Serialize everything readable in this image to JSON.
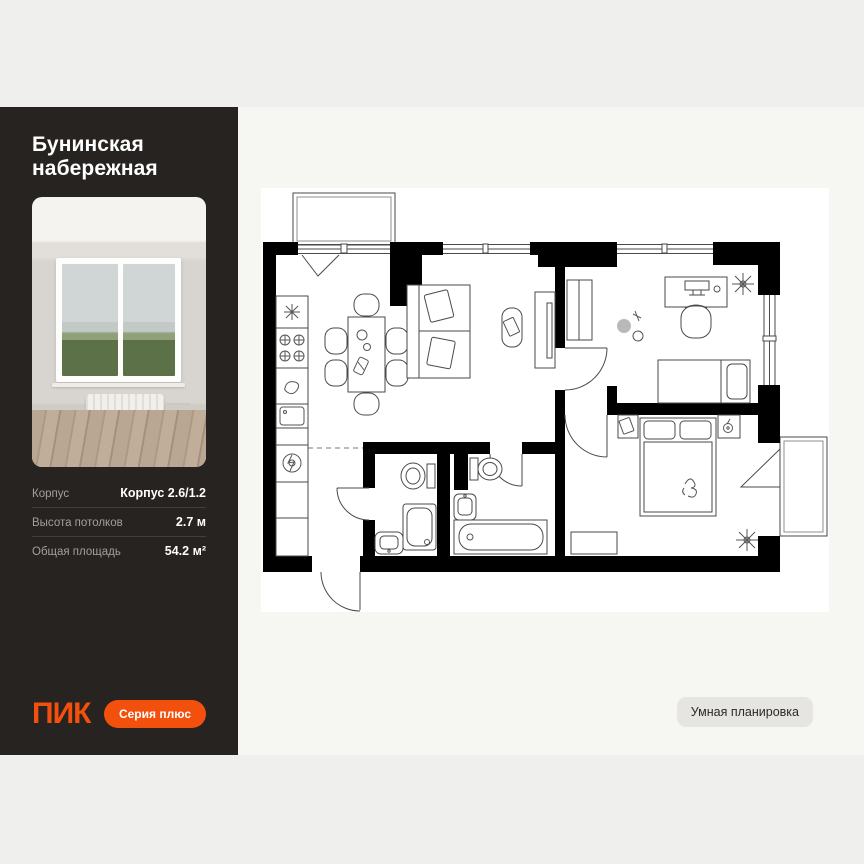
{
  "sidebar": {
    "title": "Бунинская набережная",
    "specs": [
      {
        "label": "Корпус",
        "value": "Корпус 2.6/1.2"
      },
      {
        "label": "Высота потолков",
        "value": "2.7 м"
      },
      {
        "label": "Общая площадь",
        "value": "54.2 м²"
      }
    ],
    "logo": "ПИК",
    "series_button": "Серия плюс"
  },
  "plan": {
    "smart_button": "Умная планировка"
  },
  "colors": {
    "accent_orange": "#F4500D",
    "sidebar_bg": "#262320",
    "page_bg": "#EFEFED",
    "panel_bg": "#F6F6F3",
    "plan_bg": "#FFFFFF",
    "wall_black": "#000000"
  }
}
